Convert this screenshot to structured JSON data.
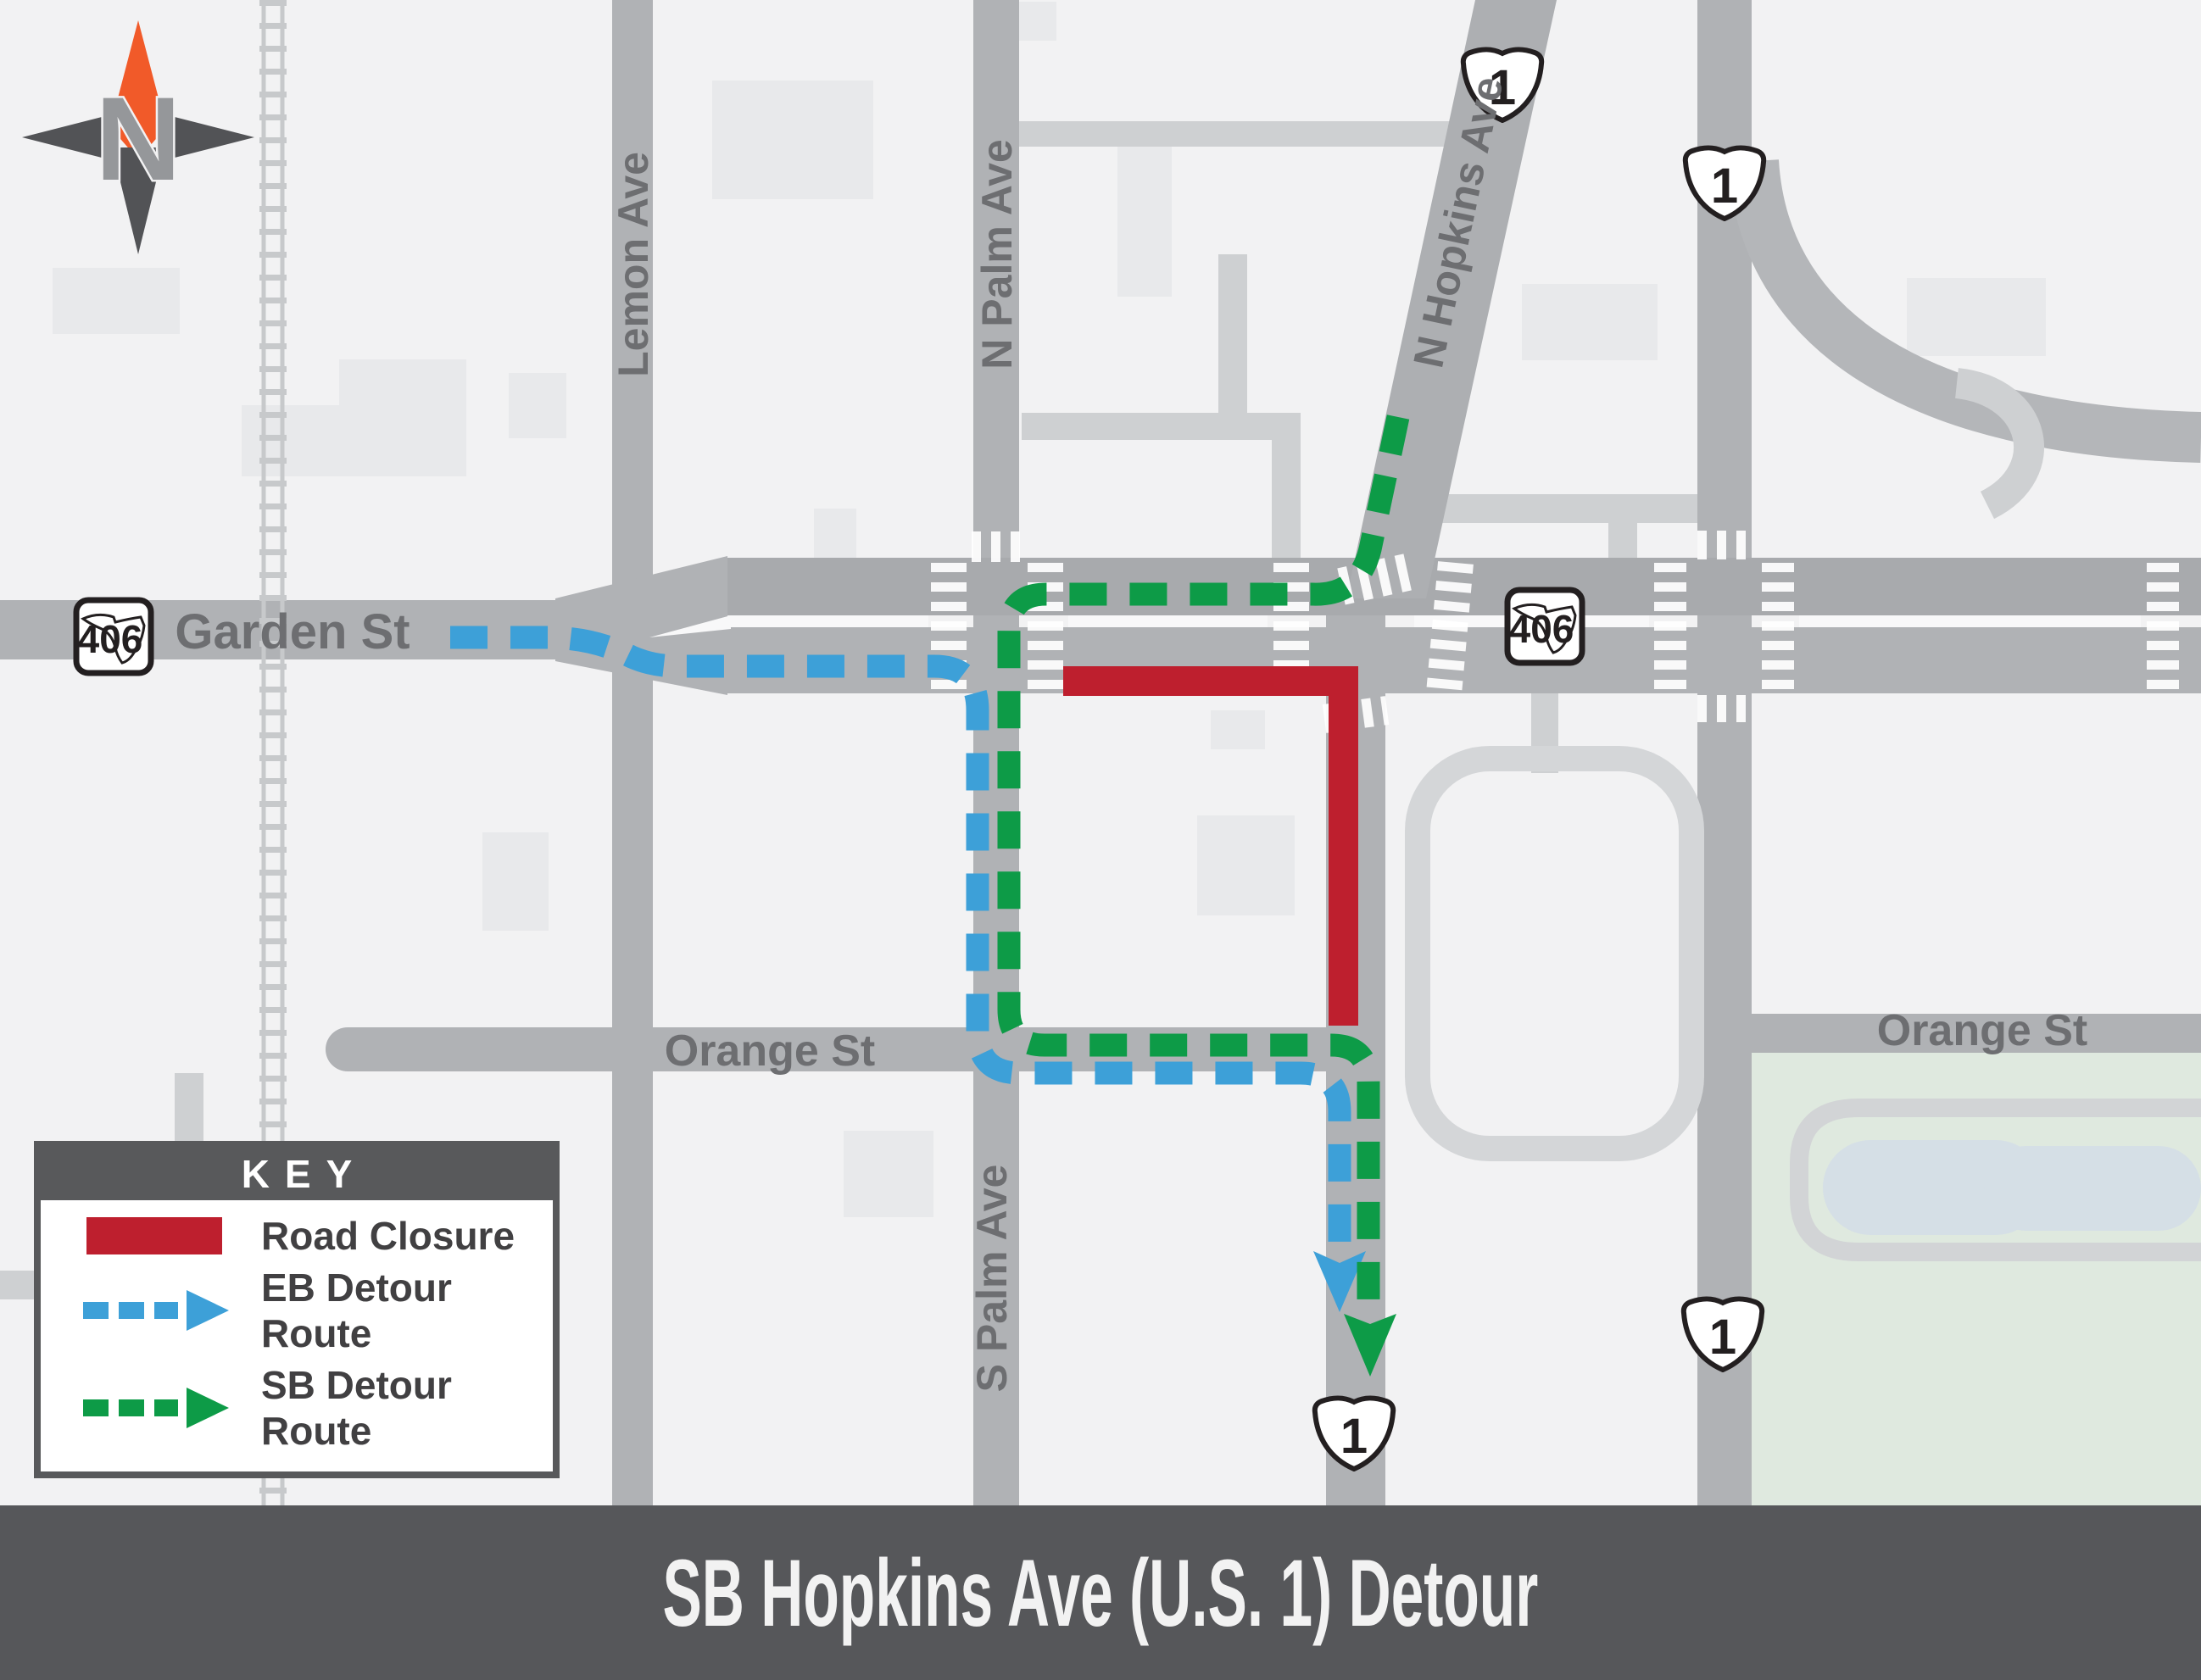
{
  "title_bar": {
    "title": "SB Hopkins Ave (U.S. 1) Detour"
  },
  "key": {
    "header": "KEY",
    "items": [
      {
        "label": "Road Closure"
      },
      {
        "label": "EB Detour Route"
      },
      {
        "label": "SB Detour Route"
      }
    ]
  },
  "streets": {
    "garden": "Garden St",
    "lemon": "Lemon Ave",
    "n_palm": "N Palm Ave",
    "s_palm": "S Palm Ave",
    "n_hopkins": "N Hopkins Ave",
    "orange_west": "Orange St",
    "orange_east": "Orange St"
  },
  "shields": {
    "us1": "1",
    "fl406": "406"
  },
  "compass": {
    "north_letter": "N"
  },
  "colors": {
    "road_closure": "#be1f2e",
    "eb_detour": "#3da0d8",
    "sb_detour": "#0d9b47",
    "road_gray": "#b0b2b5",
    "panel_dark": "#58595b"
  }
}
